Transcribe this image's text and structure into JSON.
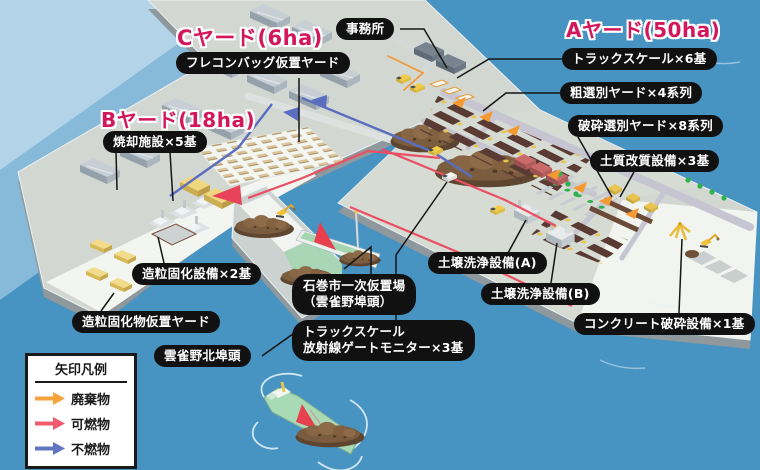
{
  "yard_titles": {
    "a": "Aヤード(50ha)",
    "b": "Bヤード(18ha)",
    "c": "Cヤード(6ha)"
  },
  "labels": {
    "office": {
      "text": "事務所"
    },
    "flecon_bag_yard": {
      "text": "フレコンバッグ仮置ヤード"
    },
    "truck_scale_6": {
      "text": "トラックスケール×6基"
    },
    "rough_sorting_yard": {
      "text": "粗選別ヤード×4系列"
    },
    "crush_sorting_yard": {
      "text": "破砕選別ヤード×8系列"
    },
    "soil_improvement": {
      "text": "土質改質設備×3基"
    },
    "incineration": {
      "text": "焼却施設×5基"
    },
    "granulation": {
      "text": "造粒固化設備×2基"
    },
    "granulation_yard": {
      "text": "造粒固化物仮置ヤード"
    },
    "hibarino_north_wharf": {
      "text": "雲雀野北埠頭"
    },
    "ishinomaki_temp_site": {
      "lines": [
        "石巻市一次仮置場",
        "（雲雀野埠頭）"
      ]
    },
    "truck_scale_gate": {
      "lines": [
        "トラックスケール",
        "放射線ゲートモニター×3基"
      ]
    },
    "soil_washing_a": {
      "text": "土壌洗浄設備(A)"
    },
    "soil_washing_b": {
      "text": "土壌洗浄設備(B)"
    },
    "concrete_crushing": {
      "text": "コンクリート破砕設備×1基"
    }
  },
  "legend": {
    "title": "矢印凡例",
    "items": [
      {
        "name": "waste",
        "label": "廃棄物",
        "color": "#F5A33C"
      },
      {
        "name": "burnable",
        "label": "可燃物",
        "color": "#F05A6E"
      },
      {
        "name": "nonburnable",
        "label": "不燃物",
        "color": "#6374C1"
      }
    ]
  },
  "colors": {
    "water": "#4793C1",
    "water_light": "#BCDAEC",
    "land": "#D2D7D2",
    "apron_white": "#F3F5F1",
    "quay_wall": "#8E989D",
    "label_bg": "#111111",
    "label_text": "#FFFFFF",
    "yard_title": "#D3175B",
    "waste_pile_brown": "#7C5C3E",
    "machine_yellow": "#E9C54F",
    "conveyor_green": "#2FB14D"
  }
}
